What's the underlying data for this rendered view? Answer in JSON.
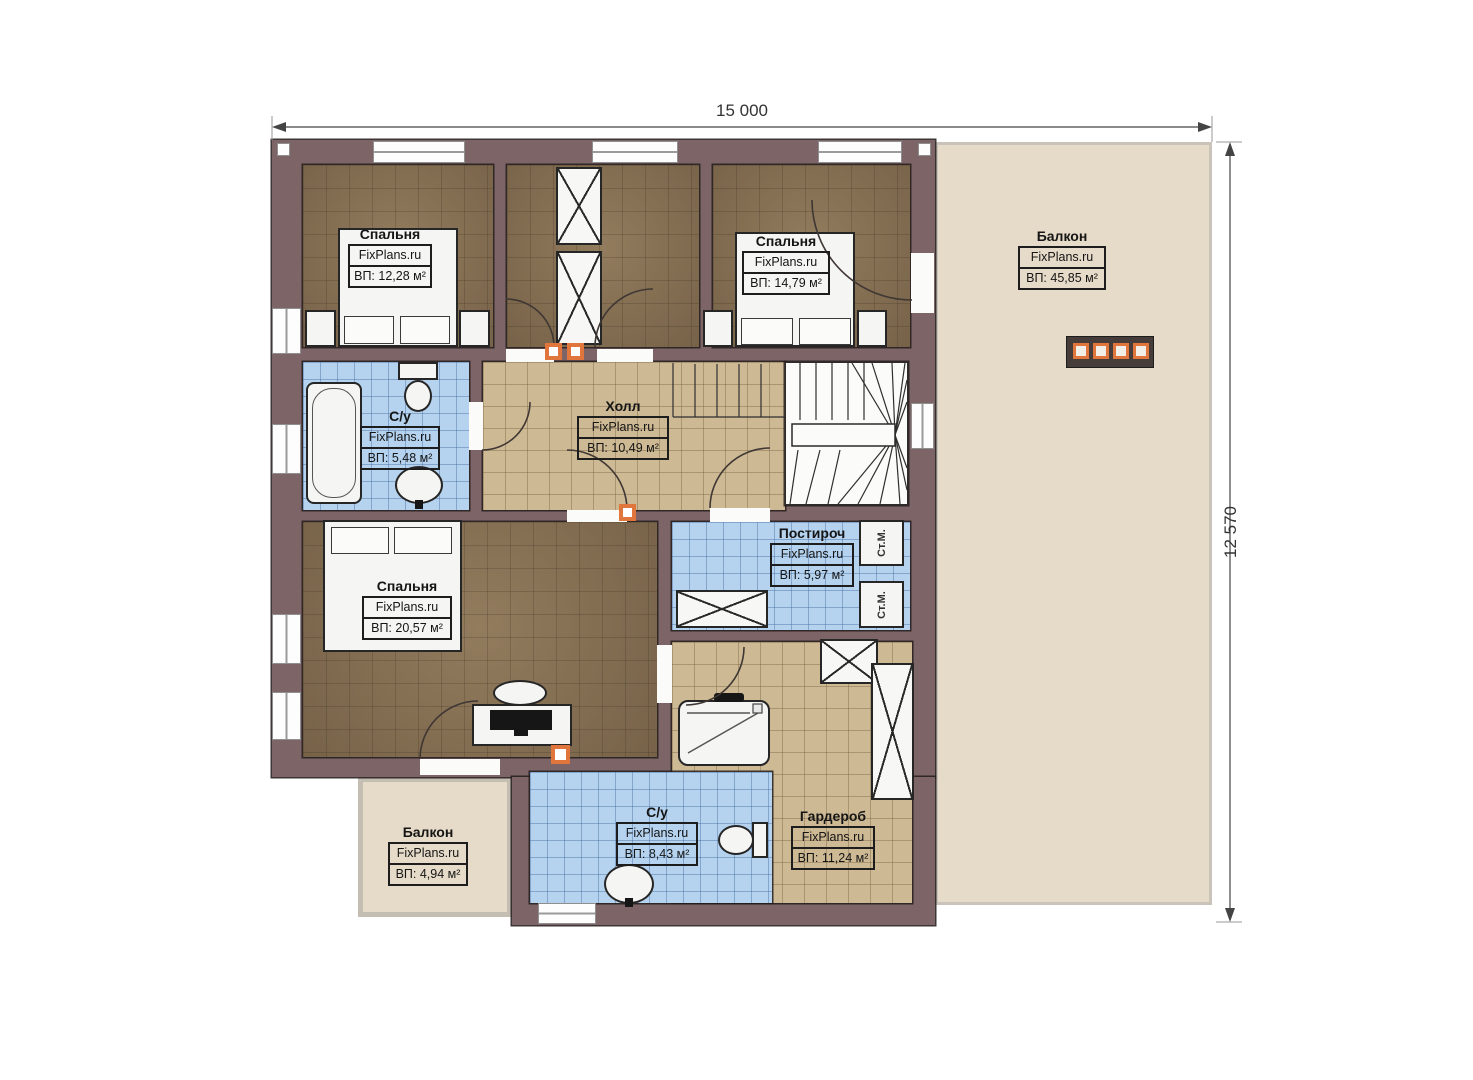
{
  "dimensions": {
    "width_total": "15 000",
    "height_total": "12 570"
  },
  "rooms": {
    "bedroom_top_left": {
      "name": "Спальня",
      "brand": "FixPlans.ru",
      "area": "ВП: 12,28 м²"
    },
    "bedroom_top_right": {
      "name": "Спальня",
      "brand": "FixPlans.ru",
      "area": "ВП: 14,79 м²"
    },
    "balcony_right": {
      "name": "Балкон",
      "brand": "FixPlans.ru",
      "area": "ВП: 45,85 м²"
    },
    "bathroom_upper": {
      "name": "С/у",
      "brand": "FixPlans.ru",
      "area": "ВП: 5,48 м²"
    },
    "hall": {
      "name": "Холл",
      "brand": "FixPlans.ru",
      "area": "ВП: 10,49 м²"
    },
    "laundry": {
      "name": "Постироч",
      "brand": "FixPlans.ru",
      "area": "ВП: 5,97 м²"
    },
    "bedroom_bottom": {
      "name": "Спальня",
      "brand": "FixPlans.ru",
      "area": "ВП: 20,57 м²"
    },
    "wardrobe": {
      "name": "Гардероб",
      "brand": "FixPlans.ru",
      "area": "ВП: 11,24 м²"
    },
    "bathroom_lower": {
      "name": "С/у",
      "brand": "FixPlans.ru",
      "area": "ВП: 8,43 м²"
    },
    "balcony_small": {
      "name": "Балкон",
      "brand": "FixPlans.ru",
      "area": "ВП: 4,94 м²"
    }
  },
  "appliances": {
    "washing_machine_label": "Ст.М."
  },
  "colors": {
    "wall": "#7d6567",
    "wood_floor": "#8a7355",
    "tile_tan": "#cdb994",
    "tile_blue": "#b5d2ee",
    "balcony_floor": "#e6dac8",
    "accent_orange": "#e0763c"
  }
}
